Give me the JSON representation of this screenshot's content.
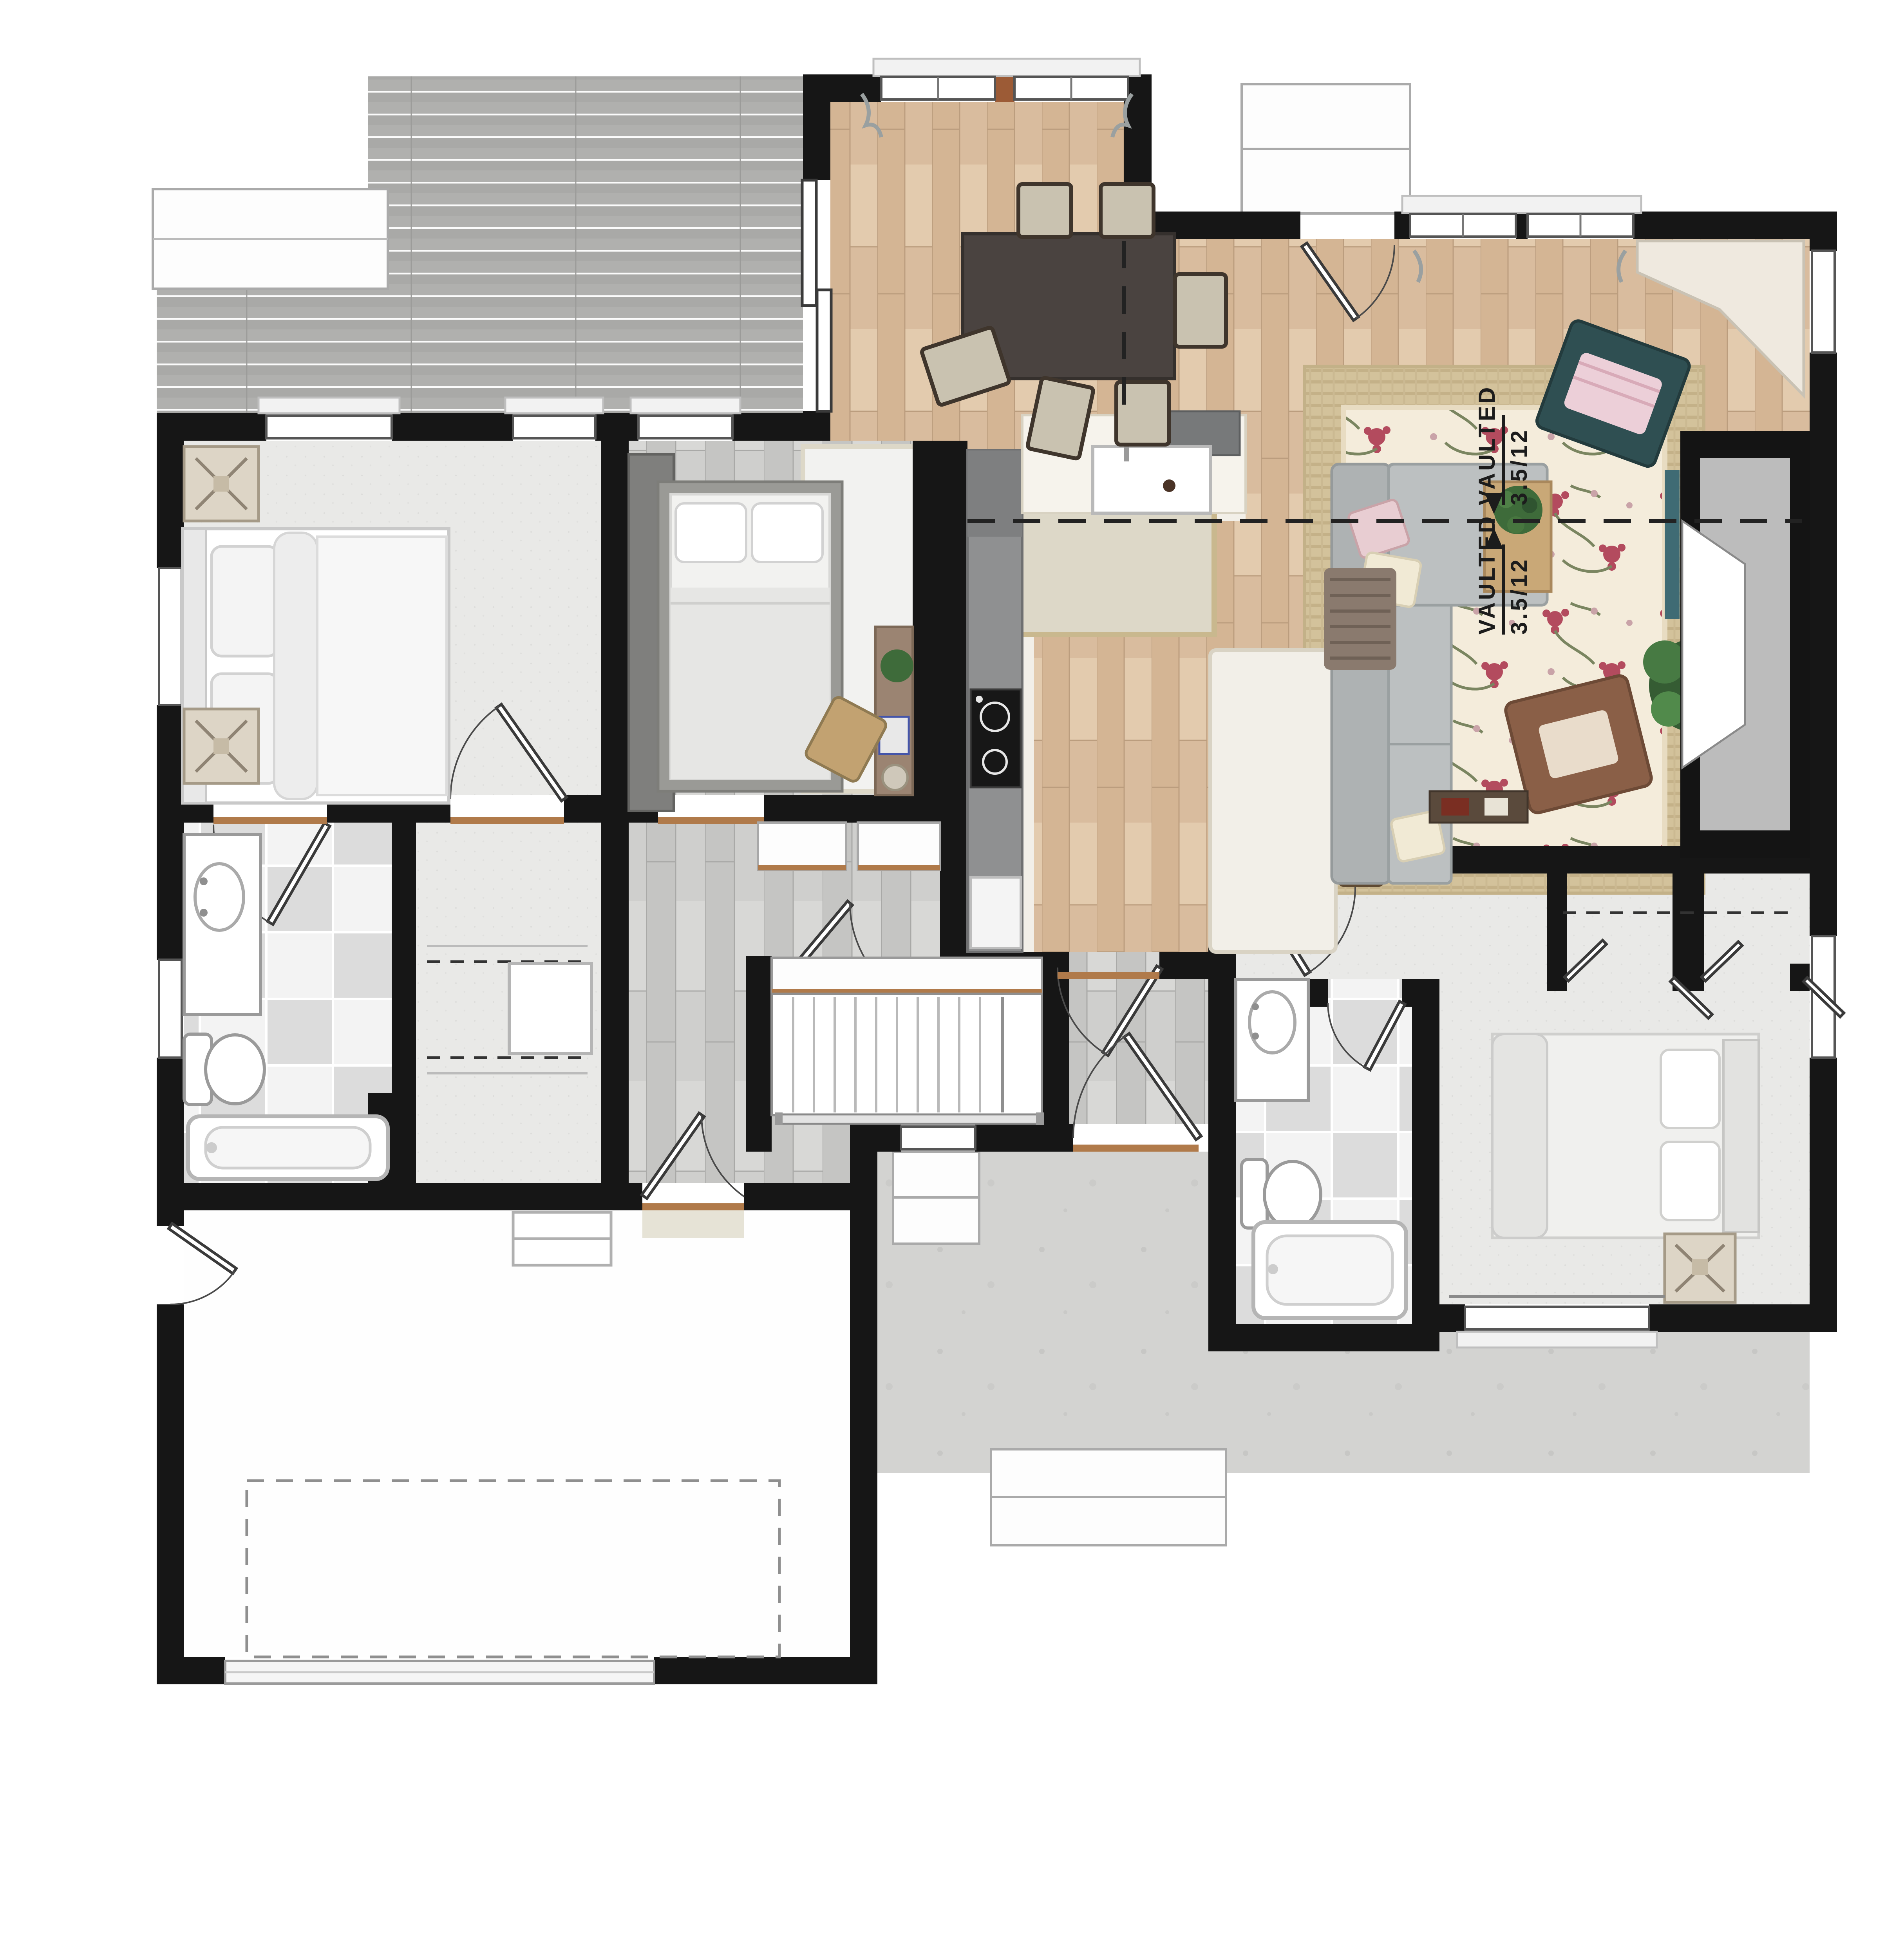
{
  "annotations": {
    "vault_upper": {
      "label": "VAULTED",
      "pitch": "3.5/12"
    },
    "vault_lower": {
      "label": "VAULTED",
      "pitch": "3.5/12"
    }
  },
  "palette": {
    "wall": "#161616",
    "wood_floor": "#d9bd9f",
    "gray_wood_floor": "#cdcdcb",
    "carpet": "#e9e9e7",
    "tile": "#e3e3e3",
    "deck": "#a9a9a7",
    "patio": "#d3d3d1",
    "island_marble": "#f2efe8",
    "counter_dark": "#77797a",
    "rug_floral_base": "#f4ecdb",
    "jute": "#d3c29b",
    "sofa": "#b8bcbd",
    "armchair_teal": "#2f4f52",
    "armchair_leather": "#8a5f47",
    "dining_table": "#4a4340",
    "plant": "#3e6b3a",
    "threshold_wood": "#b07a4a"
  },
  "rooms": [
    {
      "name": "dining-room",
      "floor": "hardwood"
    },
    {
      "name": "living-room",
      "floor": "hardwood",
      "features": [
        "fireplace",
        "tv",
        "vaulted-ceiling"
      ]
    },
    {
      "name": "kitchen",
      "floor": "hardwood-and-marble",
      "features": [
        "island",
        "sink",
        "range",
        "peninsula-counter"
      ]
    },
    {
      "name": "hallway",
      "floor": "gray-wood"
    },
    {
      "name": "entry",
      "floor": "gray-wood"
    },
    {
      "name": "stairwell",
      "floor": "wood-treads",
      "features": [
        "railing",
        "closet-above"
      ]
    },
    {
      "name": "master-bedroom",
      "floor": "carpet"
    },
    {
      "name": "walk-in-closet",
      "floor": "carpet",
      "features": [
        "rods",
        "dresser"
      ]
    },
    {
      "name": "master-bathroom",
      "floor": "checker-tile",
      "features": [
        "vanity",
        "toilet",
        "tub"
      ]
    },
    {
      "name": "bedroom-2",
      "floor": "gray-wood",
      "features": [
        "desk",
        "wardrobe"
      ]
    },
    {
      "name": "bedroom-3",
      "floor": "carpet",
      "features": [
        "double-door-closet"
      ]
    },
    {
      "name": "hall-bathroom",
      "floor": "checker-tile",
      "features": [
        "vanity",
        "toilet",
        "tub"
      ]
    },
    {
      "name": "garage",
      "floor": "concrete",
      "features": [
        "dashed-parking-outline",
        "storage-cabinet",
        "side-door",
        "garage-door"
      ]
    },
    {
      "name": "deck",
      "floor": "gray-decking",
      "features": [
        "steps"
      ]
    },
    {
      "name": "patio",
      "floor": "concrete",
      "features": [
        "steps"
      ]
    },
    {
      "name": "back-stoop",
      "floor": "concrete-steps"
    }
  ],
  "furniture": [
    "dining-table",
    "dining-chair-x6",
    "kitchen-island",
    "bar-stool-x3",
    "sectional-sofa",
    "coffee-table",
    "table-plant",
    "teal-armchair",
    "leather-armchair",
    "floor-plant",
    "tv-panel",
    "fireplace",
    "corner-cabinet",
    "low-tray-table",
    "master-bed",
    "side-table-x2",
    "bed2-bed",
    "wardrobe",
    "desk",
    "laptop",
    "desk-chair",
    "desk-plant",
    "waste-bin",
    "bed2-rug",
    "bed3-bed",
    "bed3-side-table",
    "closet-dresser",
    "garage-cabinet"
  ],
  "fixtures": [
    "kitchen-sink",
    "cooktop",
    "oven",
    "refrigerator-cabinets",
    "master-vanity-sink",
    "master-toilet",
    "master-tub",
    "hall-bath-vanity-sink",
    "hall-bath-toilet",
    "hall-bath-tub"
  ]
}
